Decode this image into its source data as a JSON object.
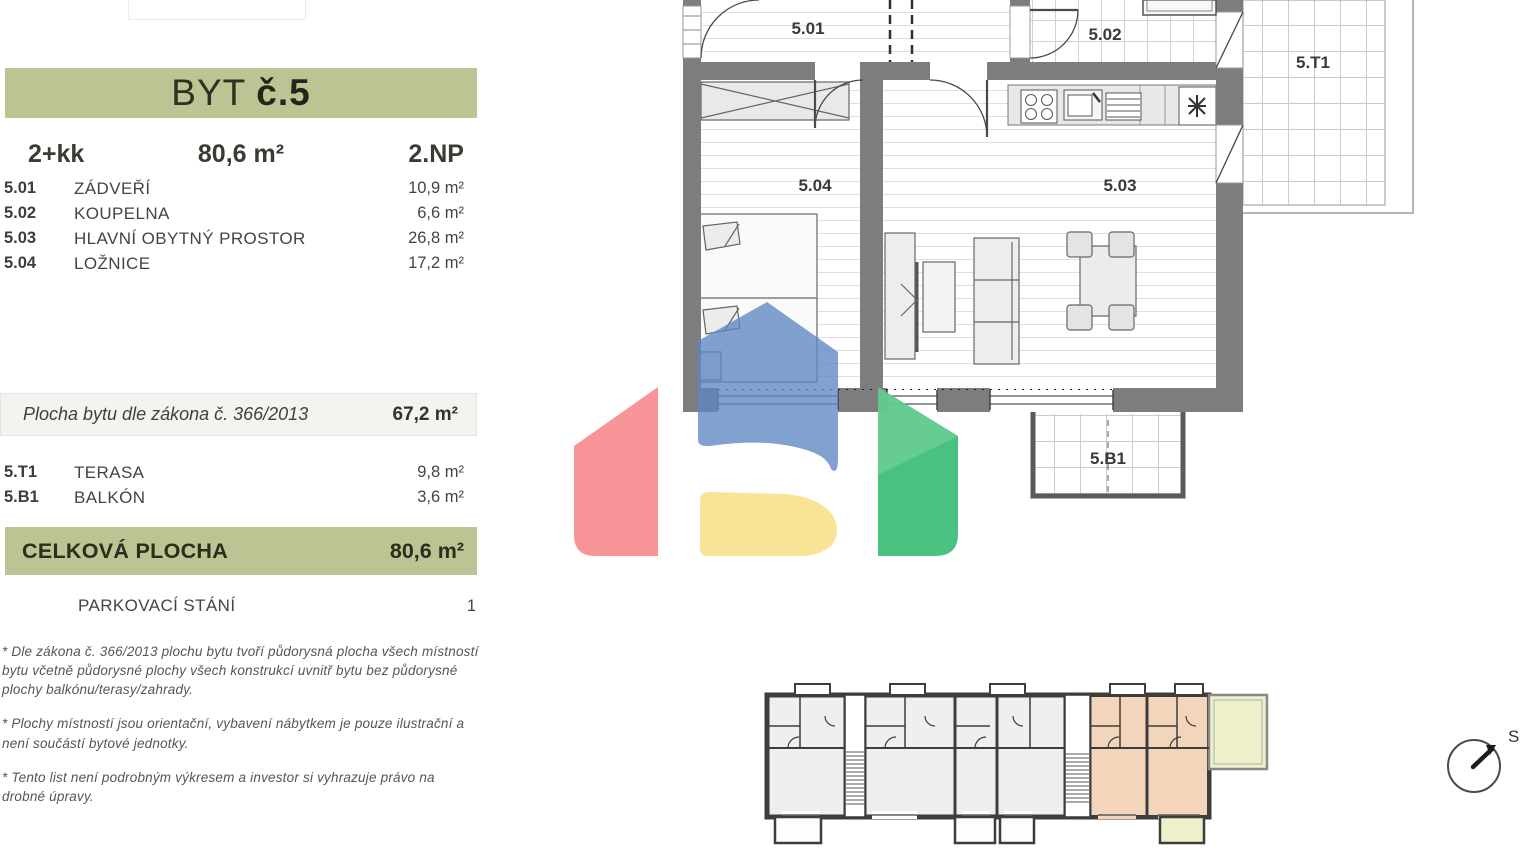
{
  "panel": {
    "title_prefix": "BYT",
    "title_number": "č.5",
    "summary": {
      "layout": "2+kk",
      "area": "80,6 m²",
      "floor": "2.NP"
    },
    "rooms": [
      {
        "code": "5.01",
        "name": "ZÁDVEŘÍ",
        "area": "10,9 m²"
      },
      {
        "code": "5.02",
        "name": "KOUPELNA",
        "area": "6,6 m²"
      },
      {
        "code": "5.03",
        "name": "HLAVNÍ OBYTNÝ PROSTOR",
        "area": "26,8 m²"
      },
      {
        "code": "5.04",
        "name": "LOŽNICE",
        "area": "17,2 m²"
      }
    ],
    "law": {
      "label": "Plocha bytu dle zákona č. 366/2013",
      "value": "67,2 m²"
    },
    "exterior": [
      {
        "code": "5.T1",
        "name": "TERASA",
        "area": "9,8 m²"
      },
      {
        "code": "5.B1",
        "name": "BALKÓN",
        "area": "3,6 m²"
      }
    ],
    "total": {
      "label": "CELKOVÁ PLOCHA",
      "value": "80,6 m²"
    },
    "parking": {
      "label": "PARKOVACÍ STÁNÍ",
      "value": "1"
    },
    "footnotes": [
      "*  Dle zákona č. 366/2013 plochu bytu tvoří půdorysná plocha všech místností bytu včetně půdorysné plochy všech konstrukcí uvnitř bytu bez půdorysné plochy balkónu/terasy/zahrady.",
      "*  Plochy místností jsou orientační, vybavení nábytkem je pouze ilustrační a není součástí bytové jednotky.",
      "*  Tento list není podrobným výkresem a investor si vyhrazuje právo na drobné úpravy."
    ]
  },
  "plan": {
    "labels": {
      "r501": "5.01",
      "r502": "5.02",
      "r503": "5.03",
      "r504": "5.04",
      "t1": "5.T1",
      "b1": "5.B1"
    }
  },
  "compass": {
    "north_label": "S"
  },
  "colors": {
    "banner_green": "#bdc392",
    "row_gray": "#f3f3f0",
    "wall_gray": "#7d7d7d",
    "overview_unit_fill": "#edeff1",
    "highlight_peach": "#f2d5ba",
    "highlight_yellow": "#eef0c9",
    "watermark_blue": "#5e88c4",
    "watermark_red": "#f68b8e",
    "watermark_green": "#3abd76",
    "watermark_yellow": "#f9e190"
  }
}
